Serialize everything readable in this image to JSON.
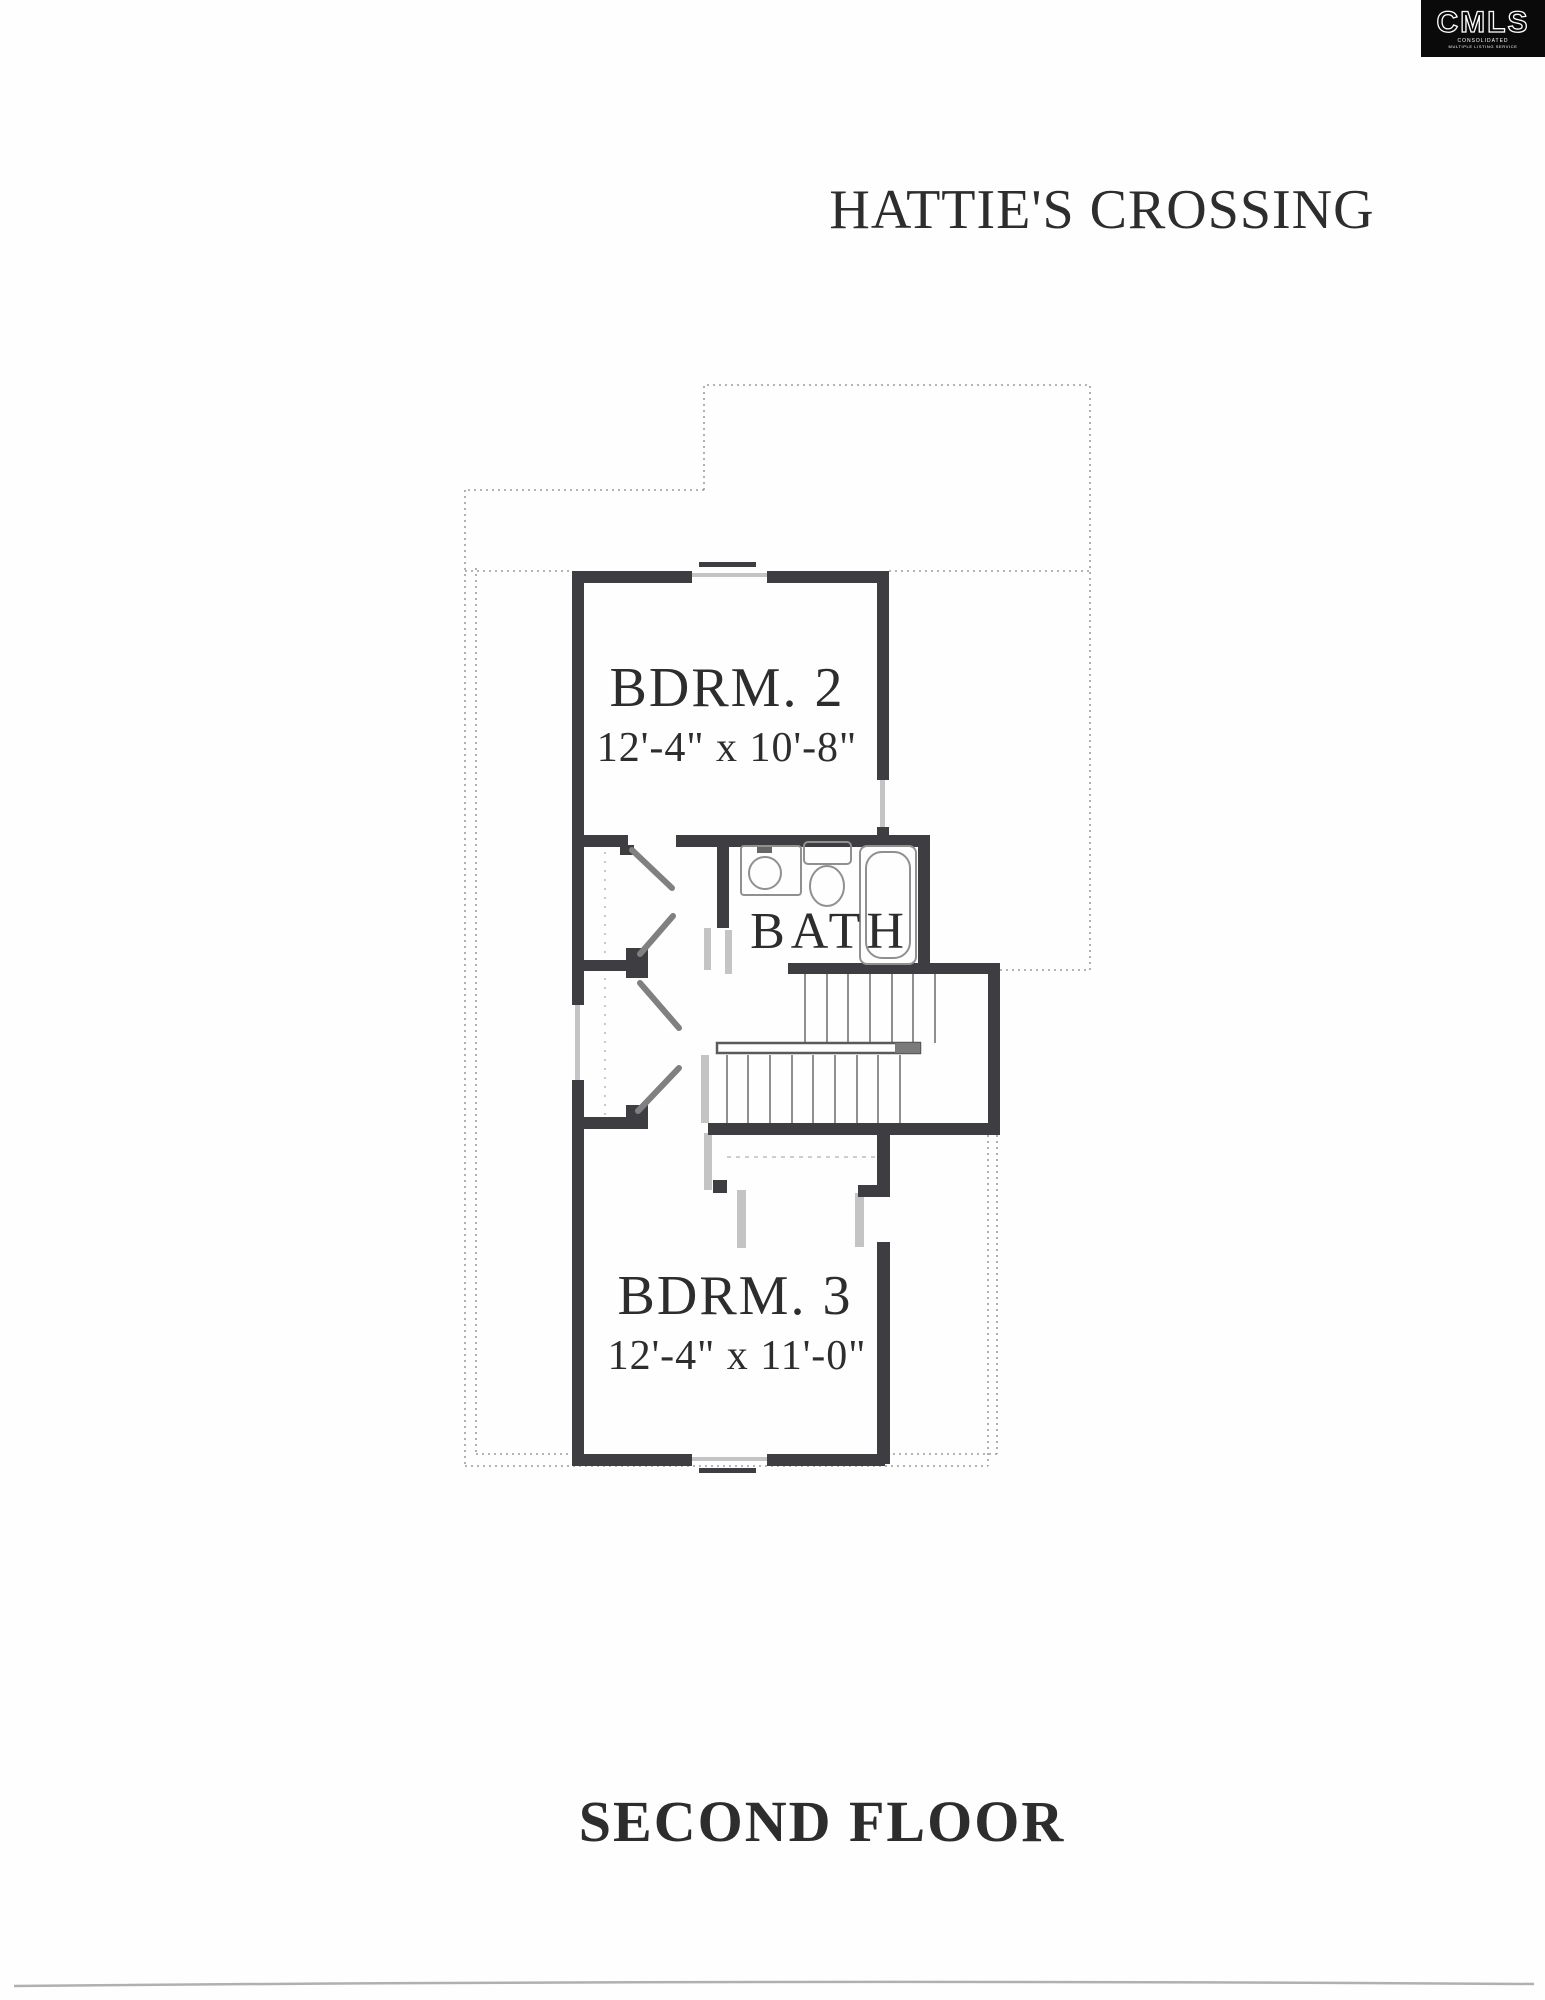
{
  "logo": {
    "text": "CMLS",
    "subtext_line1": "CONSOLIDATED",
    "subtext_line2": "MULTIPLE LISTING SERVICE"
  },
  "title": "HATTIE'S CROSSING",
  "floor_label": "SECOND FLOOR",
  "rooms": {
    "bdrm2": {
      "name": "BDRM. 2",
      "dims": "12'-4\" x 10'-8\""
    },
    "bath": {
      "name": "BATH"
    },
    "bdrm3": {
      "name": "BDRM. 3",
      "dims": "12'-4\" x 11'-0\""
    }
  },
  "colors": {
    "wall": "#3e3e42",
    "window_light": "#c4c4c4",
    "dotted_outline": "#9c9c9c",
    "fixture_outline": "#909090",
    "door_leaf": "#808080",
    "text": "#2d2d2d",
    "logo_bg": "#0a0a0a",
    "logo_fg": "#ffffff",
    "scan_line": "#b0b0b0",
    "background": "#fefefe"
  }
}
